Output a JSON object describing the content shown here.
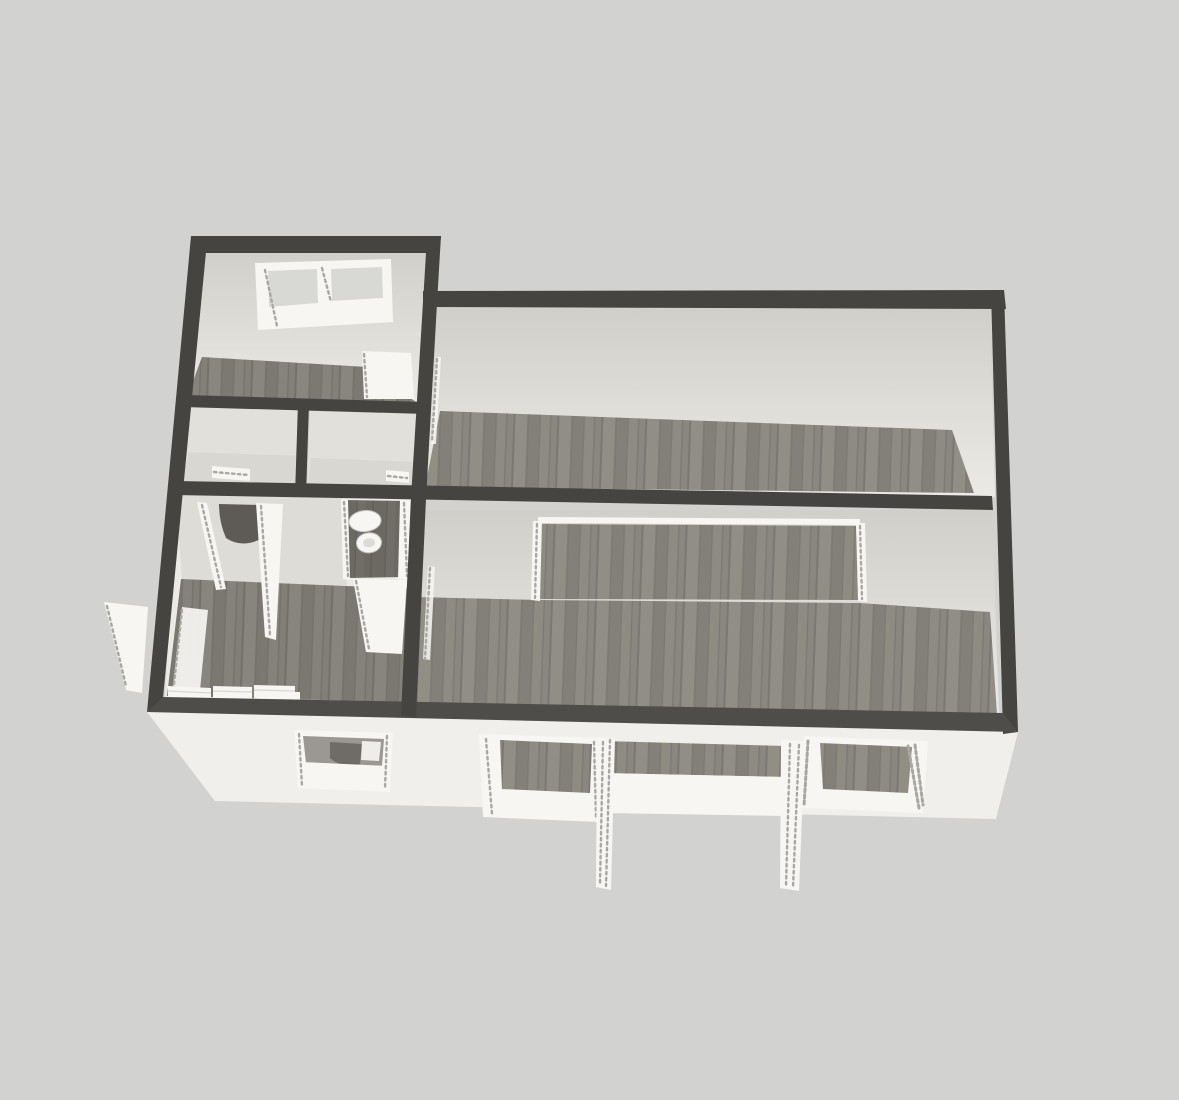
{
  "scene": {
    "kind": "floorplan-3d-render",
    "view": "perspective-from-front-above",
    "visible_text": "none"
  },
  "palette": {
    "bg": "#d2d3d0",
    "wallCap": "#454441",
    "wallCapLight": "#4e4d4a",
    "faceTop": "#d0cfc9",
    "faceBottom": "#eceae5",
    "hallFace": "#dedcd6",
    "closetFace": "#e1e0da",
    "closetFloor": "#d8d7d1",
    "facade": "#f0efeb",
    "white": "#f7f6f3",
    "speckle": "#a9a7a2",
    "woodBase": "#8a8780",
    "woodLight": "#959289",
    "woodShade": "#7c7972",
    "woodSeam": "#64615b",
    "wcFloor": "#6c6963",
    "wcSeam": "#57544f",
    "darkOpening": "#5e5b56",
    "glass": "#d8d9d5",
    "interiorShade": "#9b9893",
    "interiorBlob": "#6f6c67",
    "floorTint": "#000000"
  },
  "rooms": [
    {
      "id": "bedroom-top-left",
      "floor": "wood",
      "features": [
        "double-casement-window-north",
        "open-door-panel-southeast"
      ]
    },
    {
      "id": "closet-left",
      "floor": "light",
      "features": [
        "door-to-hall"
      ]
    },
    {
      "id": "closet-right",
      "floor": "light",
      "features": [
        "door-to-hall"
      ]
    },
    {
      "id": "room-top-right",
      "floor": "wood",
      "features": [
        "door-frame-west"
      ]
    },
    {
      "id": "living-room-bottom-right",
      "floor": "wood",
      "features": [
        "wide-wall-opening-north",
        "doorway-west",
        "window-south-left",
        "patio-door-south-open-leaves",
        "window-south-right"
      ]
    },
    {
      "id": "hall-kitchen-bottom-left",
      "floor": "wood",
      "features": [
        "wc-nook-with-toilet",
        "two-open-closet-doors",
        "kitchen-counter-row",
        "entry-door-west-open",
        "small-window-south"
      ]
    }
  ]
}
